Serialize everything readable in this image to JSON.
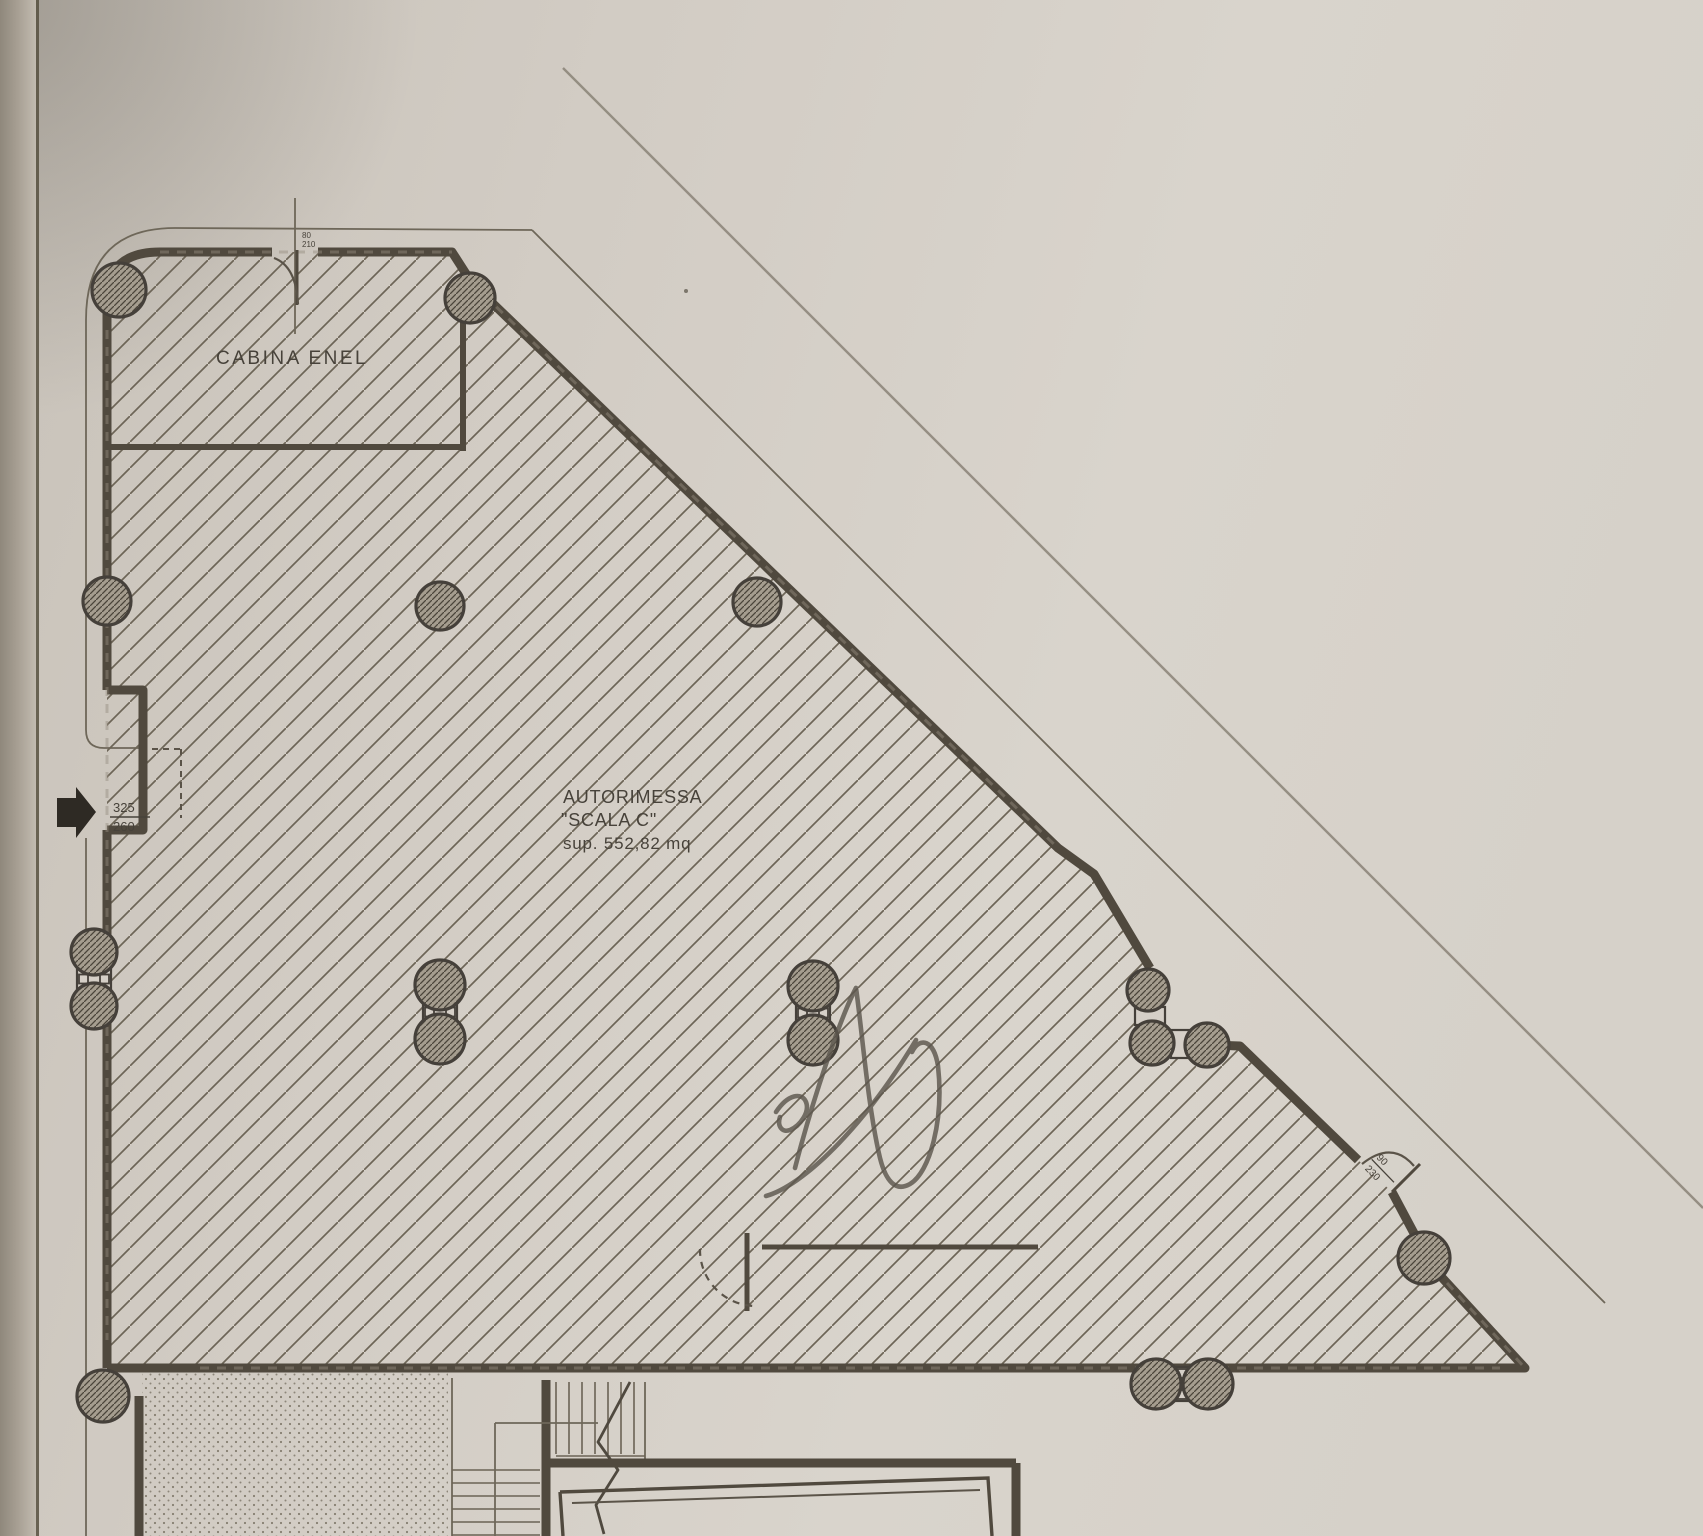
{
  "plan": {
    "kind": "scanned architectural floor plan (garage level)",
    "cabina_label": "CABINA ENEL",
    "garage_label": {
      "line1": "AUTORIMESSA",
      "line2": "\"SCALA C\"",
      "line3": "sup. 552,82 mq"
    },
    "dims": {
      "left_entrance_width": "325",
      "left_entrance_height": "260",
      "side_door_width": "90",
      "side_door_height": "230",
      "top_door_width": "80",
      "top_door_height": "210"
    },
    "annotation_letter": "A",
    "colors": {
      "paper": "#d4cec6",
      "paper_light": "#d9d4cc",
      "edge_shadow": "#9b9488",
      "ink": "#47423a",
      "wall": "#50493e",
      "hatch": "#6d6557",
      "pencil": "#8a8277"
    }
  }
}
